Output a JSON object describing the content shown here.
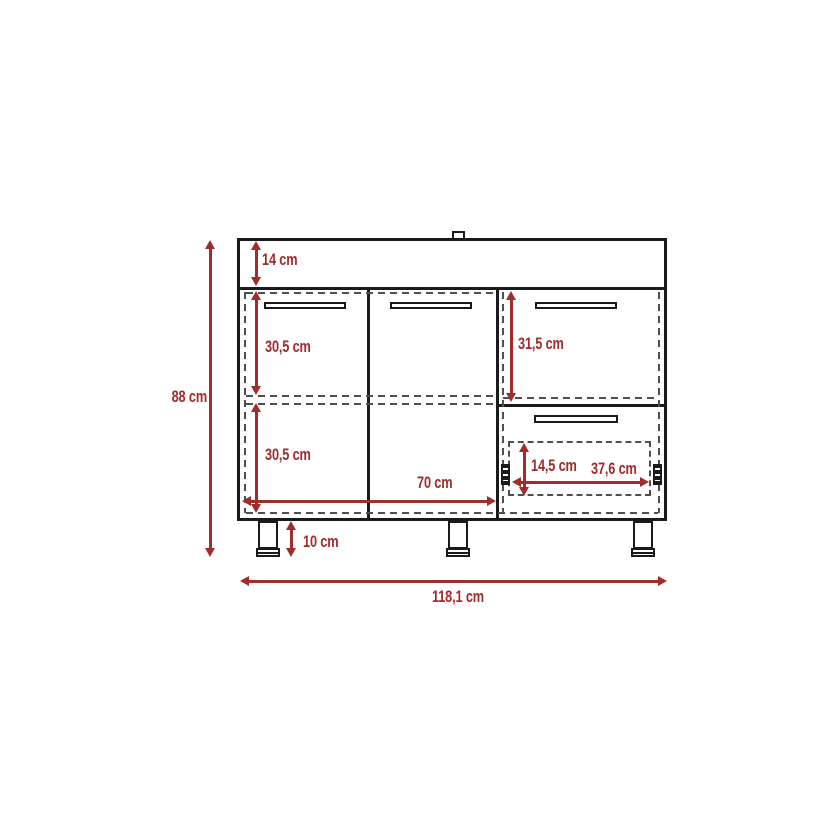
{
  "diagram": {
    "type": "furniture-dimension-drawing",
    "subject": "base cabinet front view with two doors, right drawer stack, countertop and legs",
    "unit": "cm",
    "colors": {
      "dimension_accent": "#a02c2c",
      "outline_ink": "#1a1a1a",
      "dashed_line": "#4f4f4f",
      "background": "#ffffff"
    },
    "labels": {
      "total_height": "88 cm",
      "countertop_height": "14 cm",
      "upper_section_height": "30,5 cm",
      "lower_section_height": "30,5 cm",
      "right_drawer_height": "31,5 cm",
      "doors_width": "70 cm",
      "inner_drawer_height": "14,5 cm",
      "inner_drawer_width": "37,6 cm",
      "leg_height": "10 cm",
      "total_width": "118,1 cm"
    }
  }
}
